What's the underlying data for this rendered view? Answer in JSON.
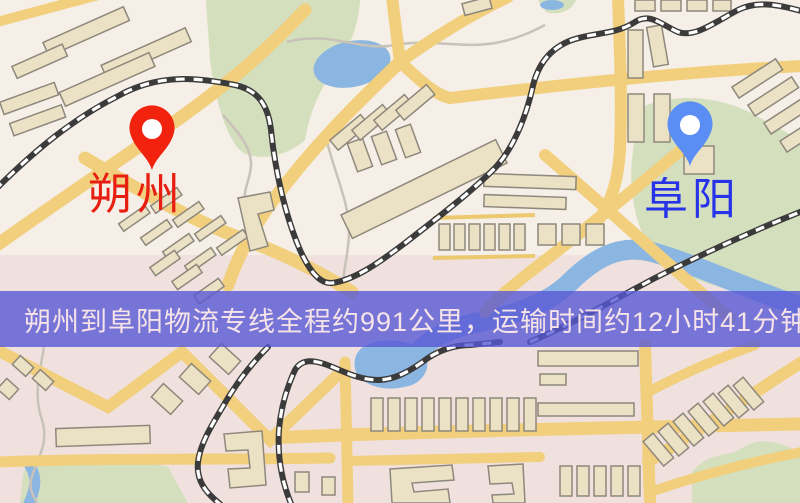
{
  "map": {
    "origin_marker": {
      "label": "朔州",
      "pin_color": "#f2230e",
      "label_color": "#e81e10"
    },
    "destination_marker": {
      "label": "阜阳",
      "pin_color": "#5b8ef4",
      "label_color": "#2733e8"
    },
    "info_banner": {
      "text": "朔州到阜阳物流专线全程约991公里，运输时间约12小时41分钟.",
      "background_color": "rgba(88,89,212,0.8)",
      "text_color": "#f5e3e8"
    },
    "colors": {
      "land": "#f5efe7",
      "land_tint": "#ddb0c2",
      "park": "#d4dfbd",
      "water": "#8cb6e2",
      "road": "#f1cf7d",
      "building_fill": "#ebe1c5",
      "building_stroke": "#8e887c",
      "railway": "#3b3b3b"
    }
  }
}
